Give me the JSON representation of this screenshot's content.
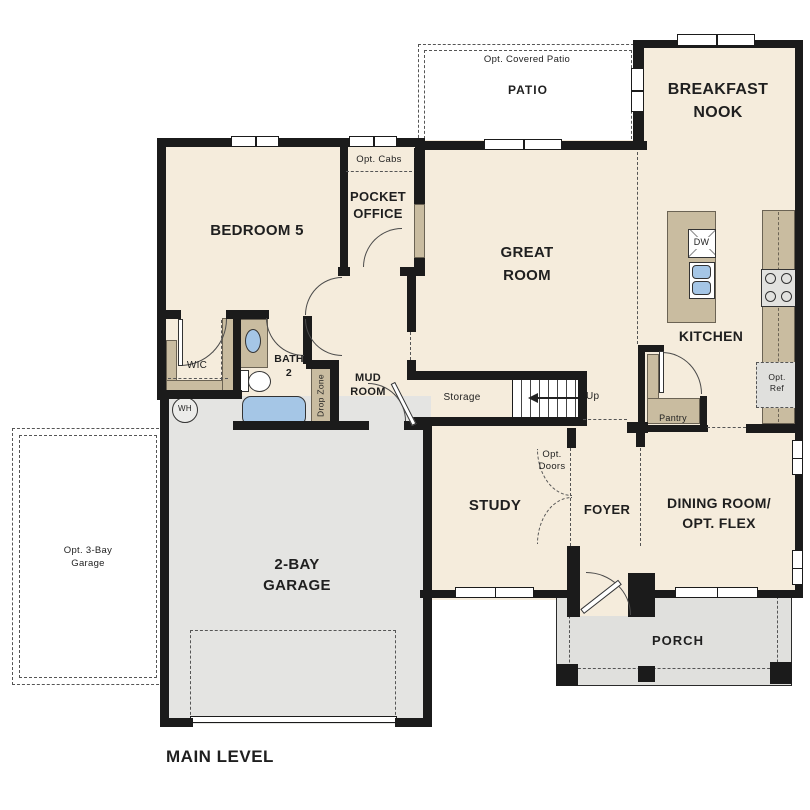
{
  "plan": {
    "type": "floor-plan",
    "level_title": "MAIN LEVEL"
  },
  "colors": {
    "floor": "#f5ecdc",
    "exterior_surface": "#e3e3e0",
    "cabinet_tan": "#c9bca0",
    "fixture_blue": "#a5c6e6",
    "wall": "#1b1b1b"
  },
  "labels": {
    "opt_covered_patio": "Opt. Covered Patio",
    "patio": "PATIO",
    "breakfast_nook": "BREAKFAST\nNOOK",
    "opt_cabs": "Opt. Cabs",
    "pocket_office": "POCKET\nOFFICE",
    "bedroom5": "BEDROOM 5",
    "great_room": "GREAT\nROOM",
    "kitchen": "KITCHEN",
    "dw": "DW",
    "wic": "WIC",
    "bath2": "BATH\n2",
    "mud_room": "MUD\nROOM",
    "storage": "Storage",
    "up": "Up",
    "opt_ref": "Opt.\nRef",
    "pantry": "Pantry",
    "drop_zone": "Drop Zone",
    "wh": "WH",
    "opt_3bay_garage": "Opt. 3-Bay\nGarage",
    "garage_2bay": "2-BAY\nGARAGE",
    "study": "STUDY",
    "opt_doors": "Opt.\nDoors",
    "foyer": "FOYER",
    "dining_room": "DINING ROOM/\nOPT. FLEX",
    "porch": "PORCH",
    "main_level": "MAIN LEVEL"
  }
}
